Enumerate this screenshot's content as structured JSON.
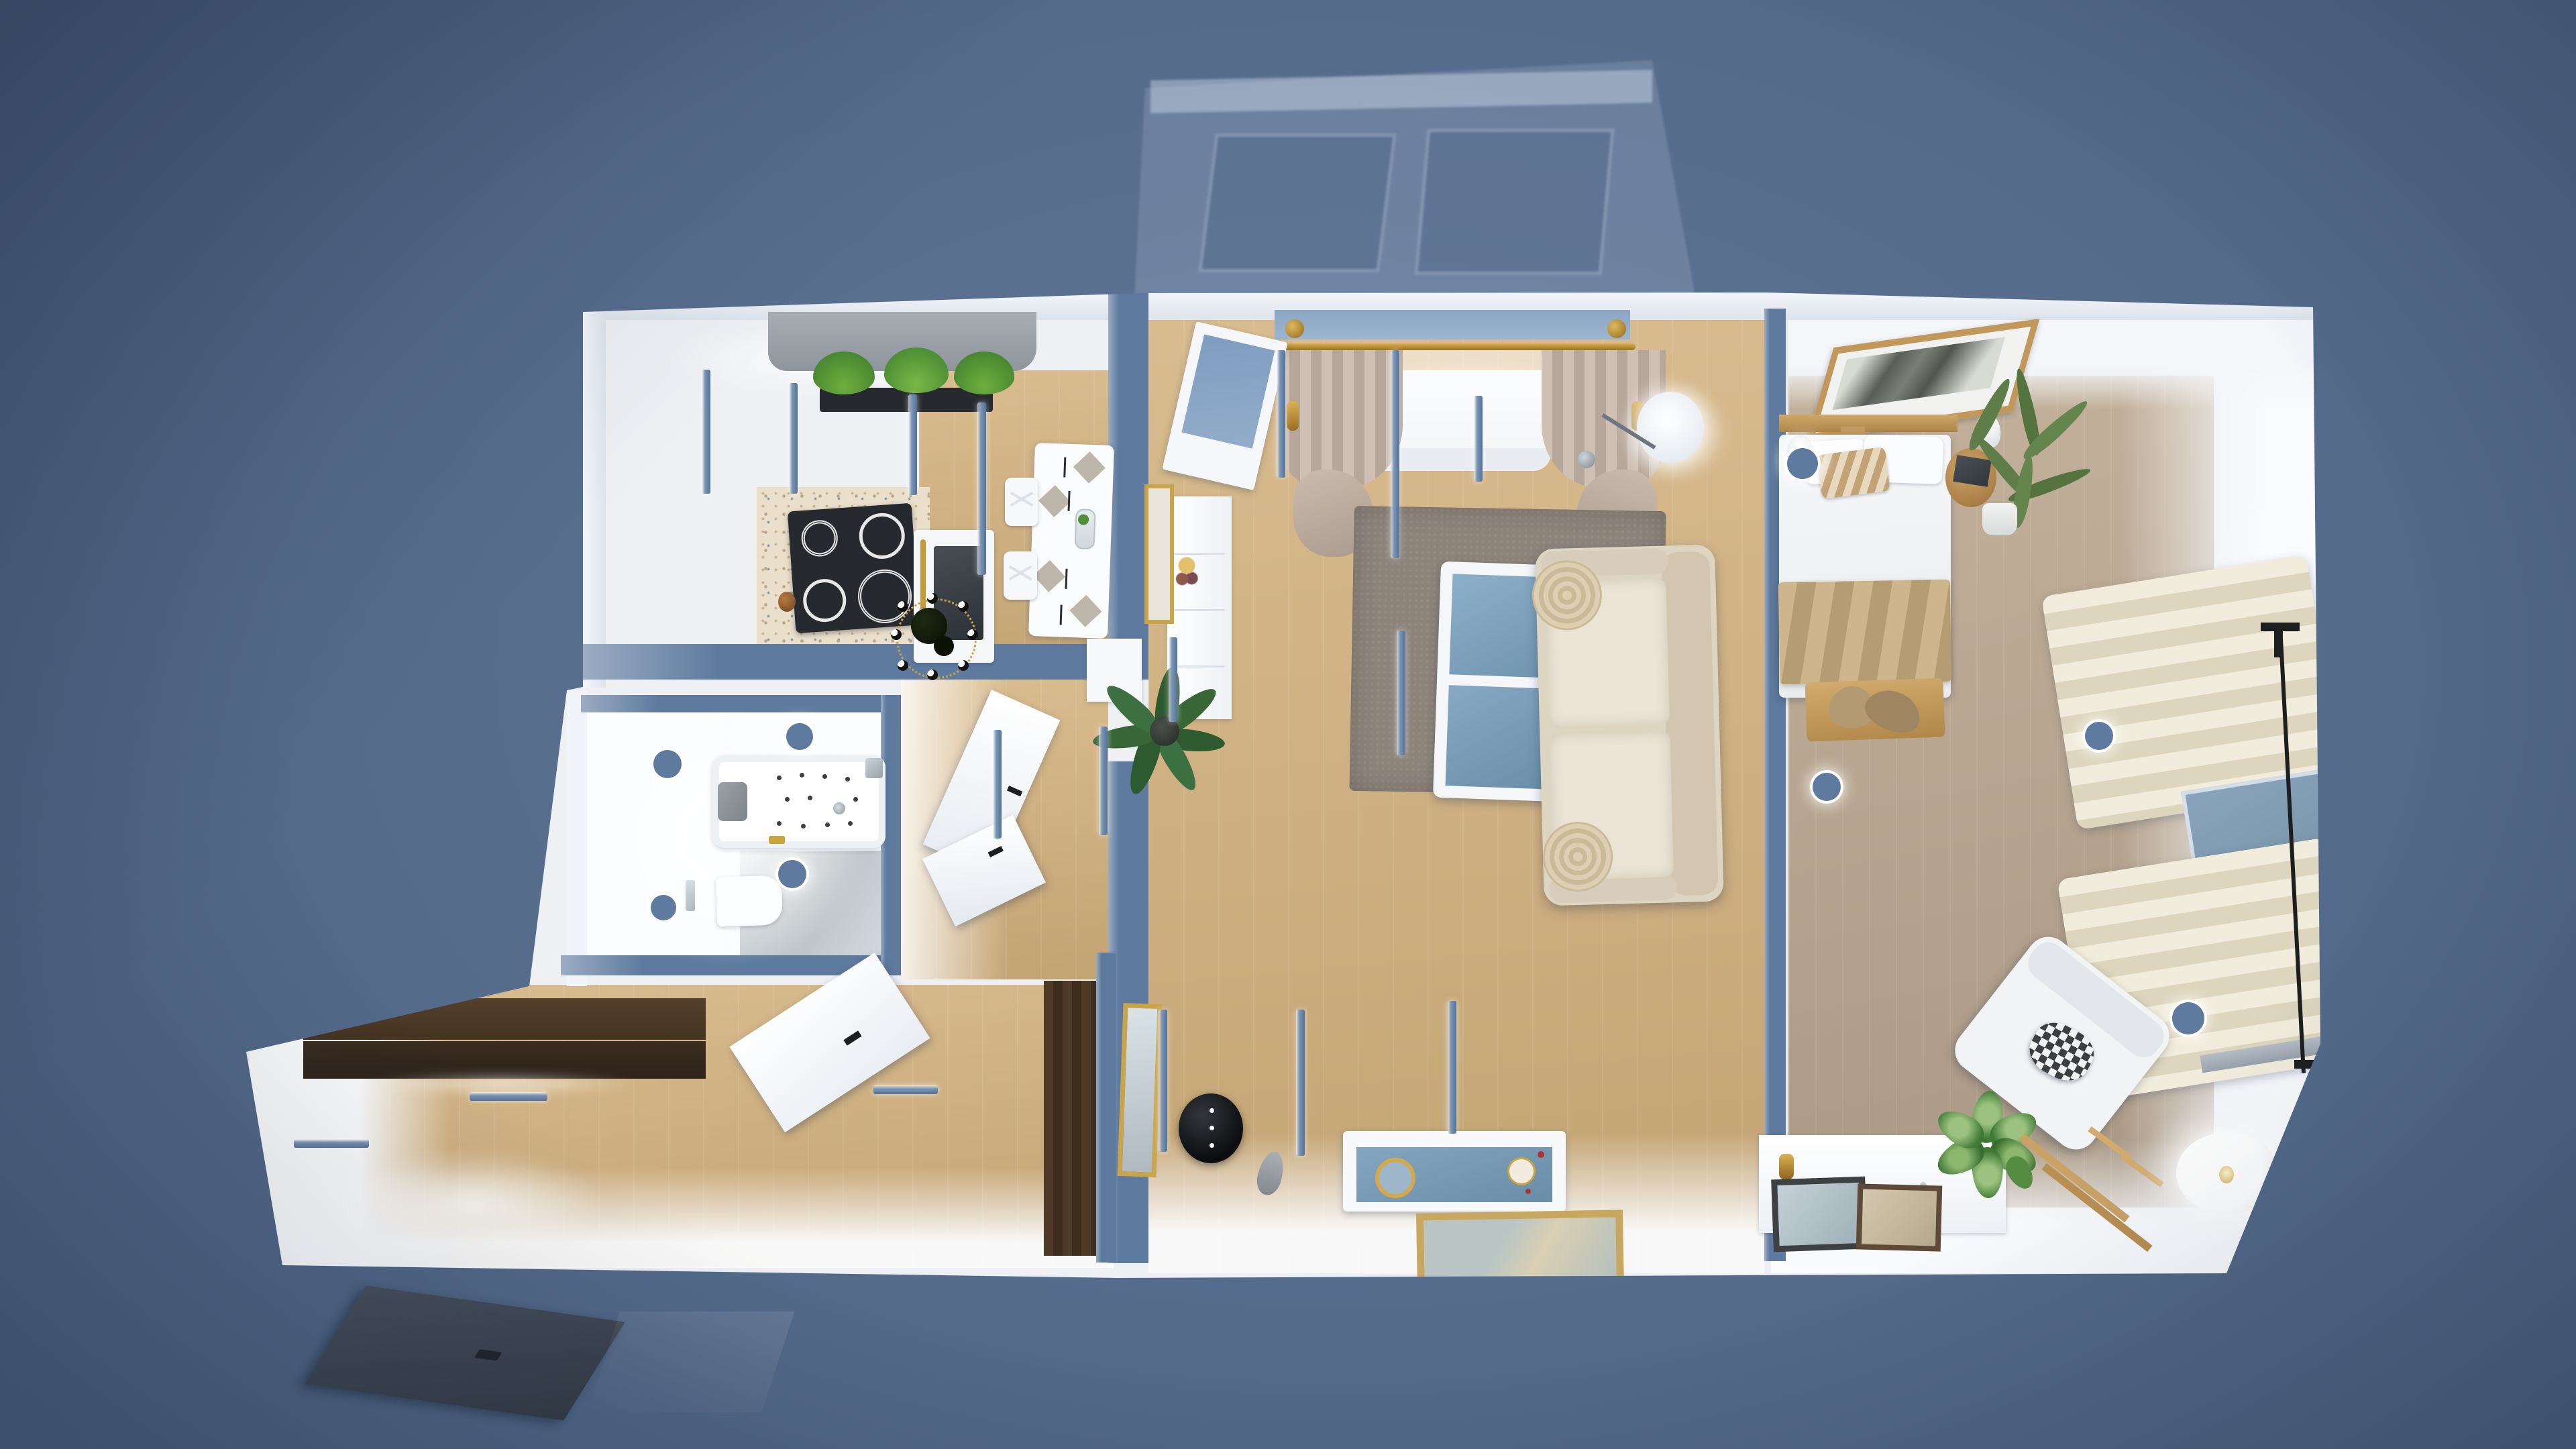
{
  "scene": {
    "kind": "3d-floor-plan-render",
    "view": "top-down dollhouse cutaway",
    "environment": "blue dusk backdrop, interior lights on",
    "rooms": [
      "kitchen",
      "living-room",
      "bedroom",
      "bathroom",
      "corridor",
      "hallway",
      "balcony"
    ]
  },
  "palette": {
    "bg1": "#62799b",
    "bg2": "#4b6180",
    "slab": "#eef0f4",
    "wall": "#ffffff",
    "walltop": "#5e7a9e",
    "woodWarm": "#d9bc8f",
    "woodWarmDark": "#c3a374",
    "woodGray": "#c3b19b",
    "woodGrayDark": "#a99884",
    "terrazzo": "#eadfcb",
    "tile": "#c9ced1",
    "rug": "#8d847a",
    "sofa": "#ded4c2",
    "cushion": "#ebe4d5",
    "pillowRound": "#d7caae",
    "curtainTaupe": "#c8b7ab",
    "curtainCream": "#ece6d2",
    "gold": "#c39a3c",
    "brass": "#bd8f2f",
    "glass": "#7fa0bb",
    "glassPale": "#8ba6c4",
    "dark": "#26292e",
    "black": "#0e1012",
    "grayBox": "#c9cfd8",
    "counter": "#686d72",
    "wenge": "#4a3827",
    "wengeDark": "#362a1e",
    "doorGray": "#3a424d",
    "greenDark": "#2e5a30",
    "green": "#568c42",
    "olive": "#5e7d49",
    "blanketTan": "#c5ad83",
    "benchWood": "#c9a265",
    "frameWood": "#c8a760",
    "bedWood": "#c29a62",
    "chrome": "#b9c2c9"
  },
  "rooms": {
    "kitchen": {
      "items": [
        "refrigerator-units",
        "shaker-cabinet",
        "dark-countertop",
        "cooktop",
        "oven",
        "upper-cabinets",
        "window-valance",
        "planter-box",
        "dining-table",
        "table-settings",
        "dining-chairs",
        "chandelier",
        "terrazzo-floor"
      ]
    },
    "living_room": {
      "items": [
        "balcony-door",
        "curtain-rod",
        "curtains",
        "sheer-curtain",
        "window-bench",
        "sideboard",
        "leaning-art-frame",
        "wall-sconce",
        "palm-plant",
        "area-rug",
        "coffee-table",
        "tufted-sofa",
        "round-pillows",
        "floor-lamp",
        "black-side-table",
        "feather-decor",
        "leaning-mirror",
        "display-cabinet",
        "floor-picture"
      ]
    },
    "bedroom": {
      "items": [
        "double-bed",
        "striped-pillow",
        "tan-blanket",
        "headboard",
        "palm-art-frame",
        "pendant-lamps",
        "round-side-table",
        "book",
        "olive-plant",
        "foot-bench",
        "clothes-pile",
        "cream-curtains",
        "window-glass",
        "curtain-brackets",
        "armchair",
        "checkered-pillow",
        "dresser",
        "potted-plants",
        "leaning-frames",
        "ladder-rack",
        "globe-floor-lamp",
        "clothes-rail"
      ]
    },
    "bathroom": {
      "items": [
        "jacuzzi-bathtub",
        "headrest",
        "faucet",
        "toilet",
        "flush-plate",
        "tile-floor",
        "ceiling-spotlights"
      ]
    },
    "hallway": {
      "items": [
        "wall-cabinets",
        "tall-wardrobe",
        "open-white-door",
        "wall-light-bars",
        "entrance-door"
      ]
    },
    "corridor": {
      "items": [
        "open-doors",
        "wall-tops"
      ]
    },
    "balcony": {
      "items": [
        "glass-enclosure",
        "window-panes"
      ]
    }
  }
}
